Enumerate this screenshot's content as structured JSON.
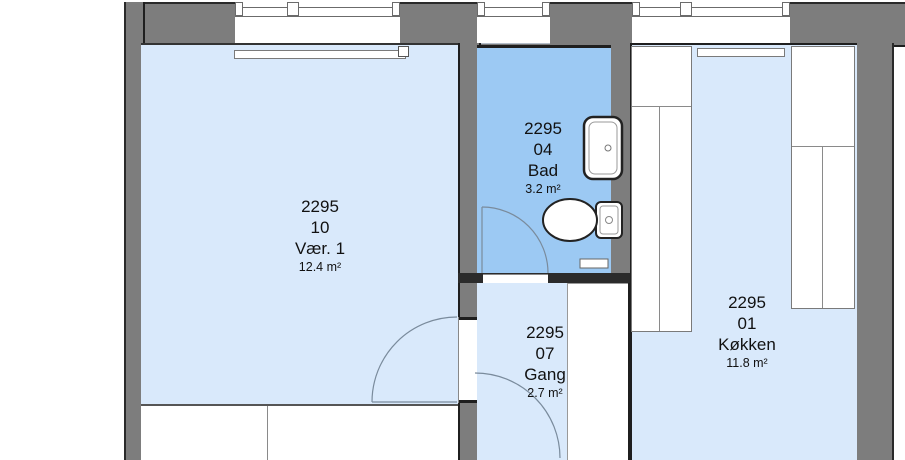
{
  "plan": {
    "type": "floor-plan-drawing",
    "rooms": [
      {
        "number": "2295",
        "unit": "10",
        "name": "Vær. 1",
        "area": "12.4 m²"
      },
      {
        "number": "2295",
        "unit": "04",
        "name": "Bad",
        "area": "3.2 m²"
      },
      {
        "number": "2295",
        "unit": "07",
        "name": "Gang",
        "area": "2.7 m²"
      },
      {
        "number": "2295",
        "unit": "01",
        "name": "Køkken",
        "area": "11.8 m²"
      }
    ],
    "fixtures": [
      "sink",
      "toilet",
      "bath-mat",
      "radiator",
      "kitchen-counter",
      "wardrobe",
      "door-swing",
      "window"
    ],
    "colors": {
      "wall": "#7d7d7d",
      "outline": "#1f1f1f",
      "floor": "#d9e9fb",
      "bathroom_floor": "#9cc9f3",
      "background": "#ffffff",
      "door_arc": "#7a8b9c"
    }
  }
}
